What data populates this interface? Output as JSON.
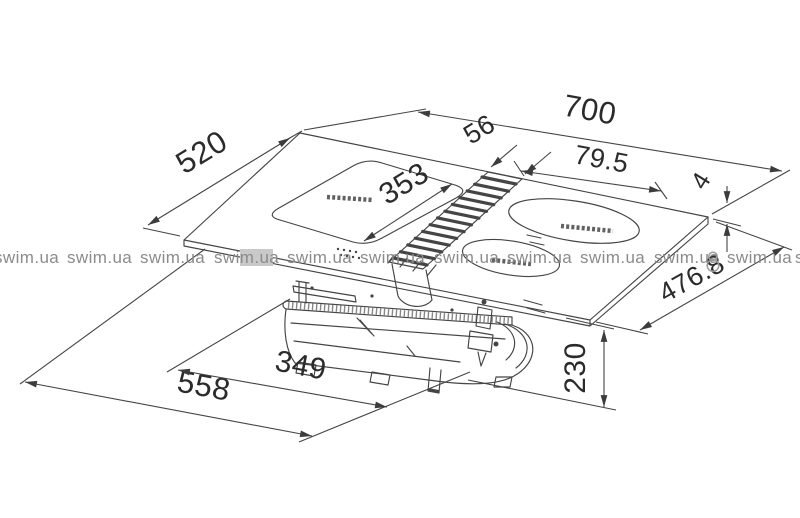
{
  "drawing": {
    "line_color": "#454545",
    "text_color": "#2b2b2b",
    "dims": {
      "d700": "700",
      "d520": "520",
      "d56": "56",
      "d79_5": "79.5",
      "d353": "353",
      "d4": "4",
      "d476_8": "476.8",
      "d558": "558",
      "d349": "349",
      "d230": "230"
    }
  },
  "watermark": {
    "text": "swim.ua",
    "color": "#8b8b8b",
    "highlight_box_color": "#c9c9c9"
  }
}
